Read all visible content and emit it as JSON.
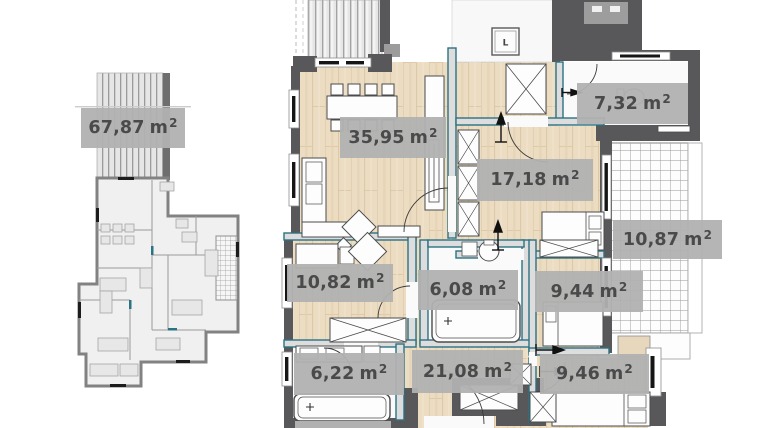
{
  "view": {
    "description_of_scene": "real-estate floor plan viewer: small overview plan left, enlarged apartment plan right",
    "background": "#ffffff"
  },
  "colors": {
    "label_background": "#b1b1b1",
    "label_text": "#4a4a4b",
    "wall_dark": "#58585a",
    "partition_teal": "#2a7383",
    "wood_floor": "#ecdcc2",
    "tile_white": "#f8f8f8"
  },
  "overview_plan": {
    "area_label": {
      "value": "67,87",
      "unit": "m",
      "sup": "2"
    }
  },
  "elevator": {
    "glyph": "L"
  },
  "labels": [
    {
      "id": "overview-total",
      "value": "67,87",
      "unit": "m",
      "sup": "2"
    },
    {
      "id": "living-room",
      "value": "35,95",
      "unit": "m",
      "sup": "2"
    },
    {
      "id": "bathroom-top",
      "value": "7,32",
      "unit": "m",
      "sup": "2"
    },
    {
      "id": "bedroom-large",
      "value": "17,18",
      "unit": "m",
      "sup": "2"
    },
    {
      "id": "balcony-right",
      "value": "10,87",
      "unit": "m",
      "sup": "2"
    },
    {
      "id": "room-left",
      "value": "10,82",
      "unit": "m",
      "sup": "2"
    },
    {
      "id": "bathroom-middle",
      "value": "6,08",
      "unit": "m",
      "sup": "2"
    },
    {
      "id": "bedroom-middle",
      "value": "9,44",
      "unit": "m",
      "sup": "2"
    },
    {
      "id": "bathroom-bottom",
      "value": "6,22",
      "unit": "m",
      "sup": "2"
    },
    {
      "id": "corridor",
      "value": "21,08",
      "unit": "m",
      "sup": "2"
    },
    {
      "id": "bedroom-bottom",
      "value": "9,46",
      "unit": "m",
      "sup": "2"
    }
  ]
}
